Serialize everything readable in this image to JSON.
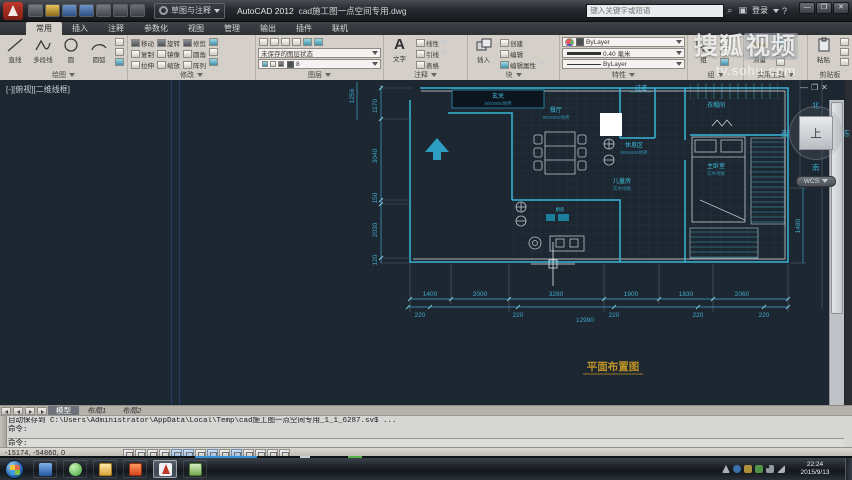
{
  "titlebar": {
    "app": "AutoCAD 2012",
    "doc": "cad施工图一点空间专用.dwg",
    "workspace": "草图与注释",
    "search_placeholder": "键入关键字或短语",
    "signin": "登录"
  },
  "icons": {
    "text_a": "A",
    "min": "–",
    "restore": "❐",
    "close": "✕",
    "search": "⌕",
    "help": "?",
    "win_min": "—",
    "win_max": "❐",
    "win_close": "✕"
  },
  "ribbon": {
    "tabs": [
      "常用",
      "插入",
      "注释",
      "参数化",
      "视图",
      "管理",
      "输出",
      "插件",
      "联机"
    ],
    "draw": {
      "title": "绘图",
      "line": "直线",
      "polyline": "多段线",
      "circle": "圆",
      "arc": "圆弧"
    },
    "modify": {
      "title": "修改",
      "items": [
        "移动",
        "旋转",
        "修剪",
        "复制",
        "镜像",
        "圆角",
        "拉伸",
        "缩放",
        "阵列"
      ]
    },
    "layers": {
      "title": "图层",
      "state": "未保存的图层状态",
      "layer": "8"
    },
    "annotate": {
      "title": "注释",
      "text": "文字",
      "linear": "线性",
      "leader": "引线",
      "table": "表格"
    },
    "block": {
      "title": "块",
      "insert": "插入",
      "create": "创建",
      "edit": "编辑",
      "edit_attr": "编辑属性"
    },
    "props": {
      "title": "特性",
      "color": "ByLayer",
      "lineweight": "0.40 毫米",
      "linetype": "ByLayer"
    },
    "group": {
      "title": "组",
      "group": "组"
    },
    "util": {
      "title": "实用工具",
      "measure": "测量"
    },
    "clip": {
      "title": "剪贴板",
      "paste": "粘贴"
    }
  },
  "watermark": {
    "brand_plain": "搜狐",
    "brand_boxed": "视频",
    "url": "tv.sohu.com"
  },
  "canvas": {
    "viewport_controls": "[-][俯视][二维线框]",
    "viewcube": {
      "n": "北",
      "s": "南",
      "e": "东",
      "w": "西",
      "top": "上",
      "wcs": "WCS"
    }
  },
  "plan": {
    "rooms": {
      "entry": {
        "name": "玄关",
        "sub": "800X800地砖"
      },
      "dining": {
        "name": "餐厅",
        "sub": "800X800地砖"
      },
      "corridor": {
        "name": "过道"
      },
      "cloak": {
        "name": "衣帽间"
      },
      "rest": {
        "name": "休息区",
        "sub": "800X800地砖"
      },
      "kids": {
        "name": "儿童房",
        "sub": "实木地板"
      },
      "master": {
        "name": "主卧室",
        "sub": "实木地板"
      },
      "kitchen": {
        "name": "厨房"
      }
    },
    "dims_bottom": [
      "1400",
      "2000",
      "3280",
      "1900",
      "1830",
      "2060"
    ],
    "dims_220": [
      "220",
      "220",
      "220",
      "220",
      "220"
    ],
    "total": "12990",
    "dims_left": [
      "1256",
      "1170",
      "3040",
      "150",
      "2030",
      "120"
    ],
    "dim_right": "1480",
    "title": "平面布置图"
  },
  "layout_bar": {
    "tabs": [
      "模型",
      "布局1",
      "布局2"
    ]
  },
  "command": {
    "history1": "自动保存到 C:\\Users\\Administrator\\AppData\\Local\\Temp\\cad施工图一点空间专用_1_1_6287.sv$ ...",
    "history2": "命令:",
    "prompt": "命令:"
  },
  "statusbar": {
    "coords": "-15174, -54860, 0"
  },
  "taskbar": {
    "time": "22:24",
    "date": "2015/9/13"
  }
}
